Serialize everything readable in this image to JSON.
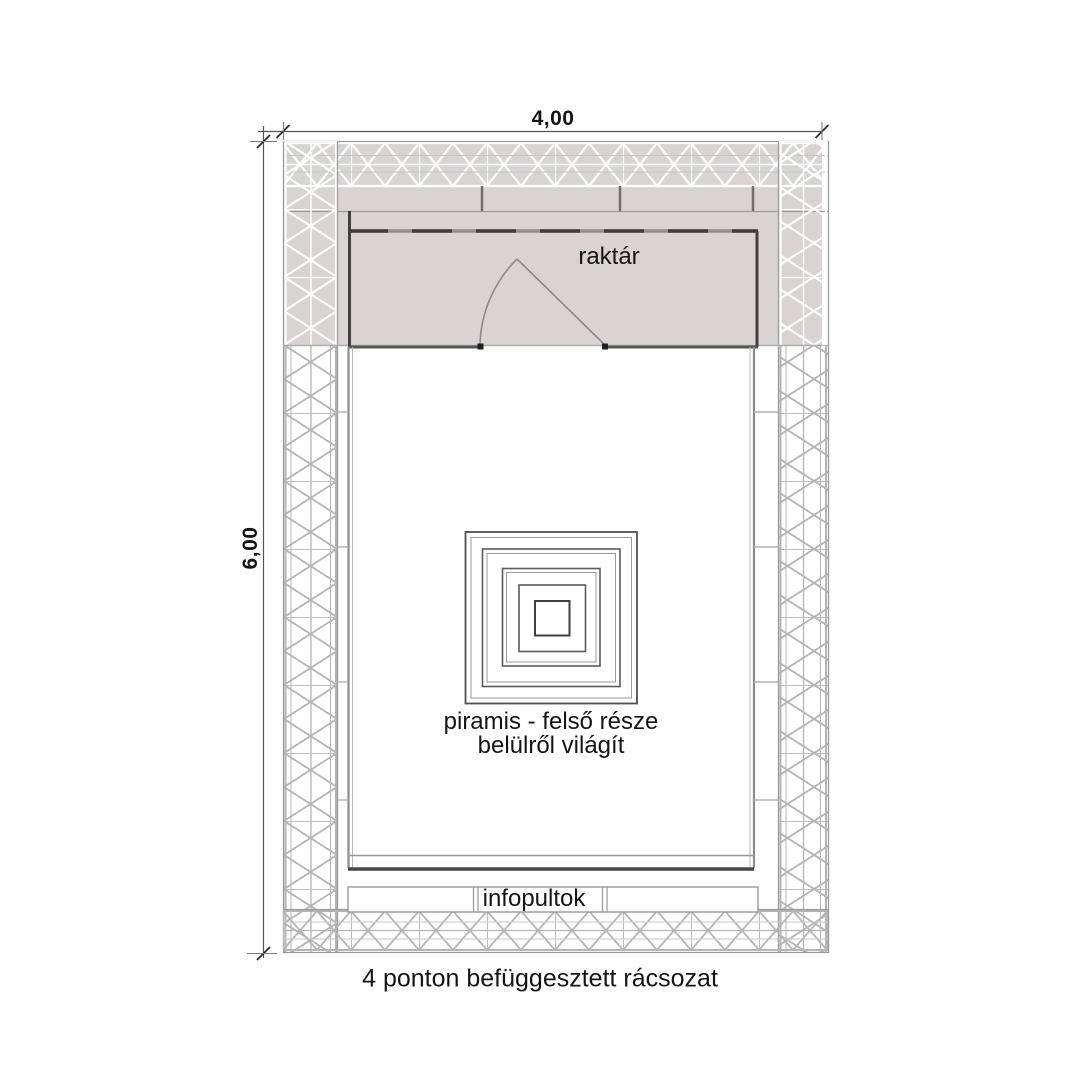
{
  "drawing": {
    "dimensions": {
      "horizontal": "4,00",
      "vertical": "6,00"
    },
    "labels": {
      "storage": "raktár",
      "pyramid_line1": "piramis - felső része",
      "pyramid_line2": "belülről világít",
      "info_desks": "infopultok"
    },
    "caption": "4 ponton befüggesztett rácsozat",
    "colors": {
      "storage_fill": "#d8d4d4",
      "truss_line_light": "#b6b4b4",
      "truss_line_white": "#ffffff",
      "wall_dark": "#3f3f3f",
      "frame_gray": "#9a9a9a",
      "text": "#151515"
    }
  }
}
